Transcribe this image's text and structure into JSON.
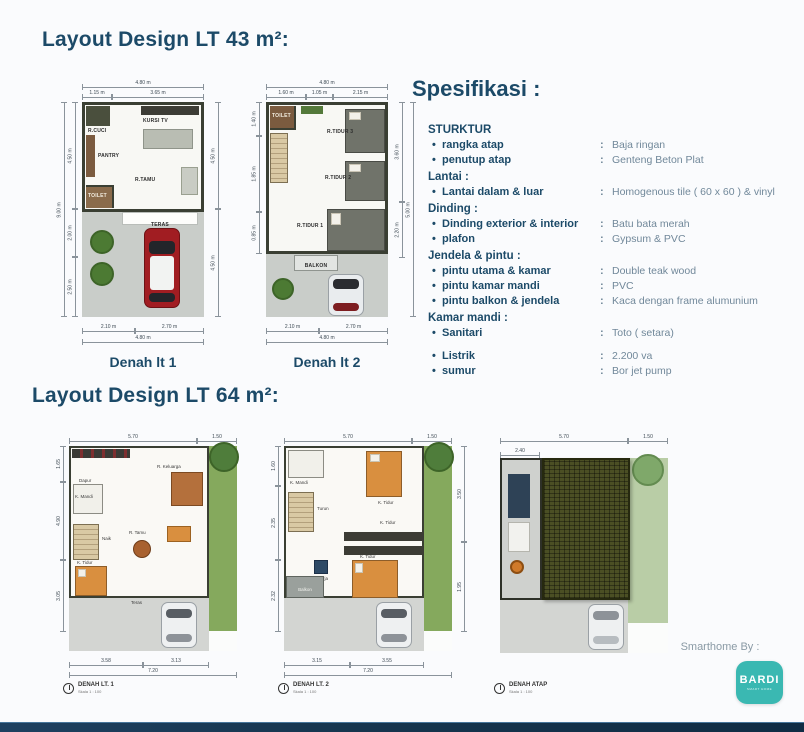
{
  "page": {
    "background": "#fafbfd",
    "accent_navy": "#1c4a68",
    "value_gray": "#71889a",
    "footer_bar_color": "#16354e",
    "bardi_teal": "#3ab8b2"
  },
  "section_43": {
    "title": "Layout Design LT 43 m²:"
  },
  "section_64": {
    "title": "Layout Design LT 64 m²:"
  },
  "plan43_1": {
    "caption": "Denah lt 1",
    "dims": {
      "top_total": "4.80 m",
      "top_a": "1.15 m",
      "top_b": "3.65 m",
      "left_outer": "9.00 m",
      "left_a": "4.50 m",
      "left_b": "2.00 m",
      "left_c": "2.50 m",
      "right_a": "4.50 m",
      "right_b": "4.50 m",
      "bottom_a": "2.10 m",
      "bottom_b": "2.70 m",
      "bottom_total": "4.80 m"
    },
    "rooms": {
      "cuci": "R.CUCI",
      "kursi_tv": "KURSI TV",
      "pantry": "PANTRY",
      "tamu": "R.TAMU",
      "toilet": "TOILET",
      "teras": "TERAS"
    }
  },
  "plan43_2": {
    "caption": "Denah lt 2",
    "dims": {
      "top_total": "4.80 m",
      "top_a": "1.60 m",
      "top_b": "1.05 m",
      "top_c": "2.15 m",
      "left_a": "1.40 m",
      "left_b": "1.85 m",
      "left_c": "0.85 m",
      "right_a": "3.60 m",
      "right_b": "2.20 m",
      "right_outer": "5.00 m",
      "bottom_a": "2.10 m",
      "bottom_b": "2.70 m",
      "bottom_total": "4.80 m"
    },
    "rooms": {
      "toilet": "TOILET",
      "tidur3": "R.TIDUR 3",
      "tidur2": "R.TIDUR 2",
      "tidur1": "R.TIDUR 1",
      "balkon": "BALKON"
    }
  },
  "spec": {
    "title": "Spesifikasi :",
    "separator": ":",
    "bullet": "•",
    "groups": [
      {
        "heading": "STURKTUR",
        "items": [
          {
            "label": "rangka atap",
            "value": "Baja ringan"
          },
          {
            "label": "penutup atap",
            "value": "Genteng Beton Plat"
          }
        ]
      },
      {
        "heading": "Lantai :",
        "items": [
          {
            "label": "Lantai dalam & luar",
            "value": "Homogenous tile ( 60 x 60 ) & vinyl"
          }
        ]
      },
      {
        "heading": "Dinding :",
        "items": [
          {
            "label": "Dinding exterior & interior",
            "value": "Batu bata merah"
          },
          {
            "label": "plafon",
            "value": "Gypsum & PVC"
          }
        ]
      },
      {
        "heading": "Jendela & pintu :",
        "items": [
          {
            "label": "pintu utama & kamar",
            "value": "Double teak wood"
          },
          {
            "label": "pintu kamar mandi",
            "value": "PVC"
          },
          {
            "label": "pintu balkon & jendela",
            "value": "Kaca dengan frame alumunium"
          }
        ]
      },
      {
        "heading": "Kamar mandi :",
        "items": [
          {
            "label": "Sanitari",
            "value": "Toto ( setara)"
          }
        ]
      },
      {
        "heading": "",
        "items": [
          {
            "label": "Listrik",
            "value": "2.200 va"
          },
          {
            "label": "sumur",
            "value": "Bor jet pump"
          }
        ]
      }
    ]
  },
  "plan64_1": {
    "caption": "DENAH LT. 1",
    "scale": "Skala 1 : 100",
    "dims": {
      "top_a": "5.70",
      "top_b": "1.50",
      "left_a": "1.65",
      "left_b": "4.90",
      "left_c": "3.05",
      "bottom_a": "3.58",
      "bottom_b": "3.13",
      "bottom_total": "7.20"
    },
    "rooms": {
      "dapur": "Dapur",
      "keluarga": "R. Keluarga",
      "mandi": "K. Mandi",
      "naik": "Naik",
      "tamu": "R. Tamu",
      "tidur": "K. Tidur",
      "teras": "Teras"
    }
  },
  "plan64_2": {
    "caption": "DENAH LT. 2",
    "scale": "Skala 1 : 100",
    "dims": {
      "top_a": "5.70",
      "top_b": "1.50",
      "left_a": "1.60",
      "left_b": "2.35",
      "left_c": "2.32",
      "right_a": "3.50",
      "right_b": "1.95",
      "bottom_a": "3.15",
      "bottom_b": "3.55",
      "bottom_total": "7.20"
    },
    "rooms": {
      "mandi": "K. Mandi",
      "turun": "Turun",
      "tidur_a": "K. Tidur",
      "tidur_b": "K. Tidur",
      "kerja": "K. Kerja",
      "balkon": "Balkon",
      "tidur_c": "K. Tidur"
    }
  },
  "plan64_3": {
    "caption": "DENAH ATAP",
    "scale": "Skala 1 : 100",
    "dims": {
      "top_a": "5.70",
      "top_b": "1.50",
      "left_a": "2.40"
    }
  },
  "footer": {
    "smarthome_label": "Smarthome By :",
    "logo_text": "BARDI",
    "logo_sub": "SMART HOME"
  }
}
